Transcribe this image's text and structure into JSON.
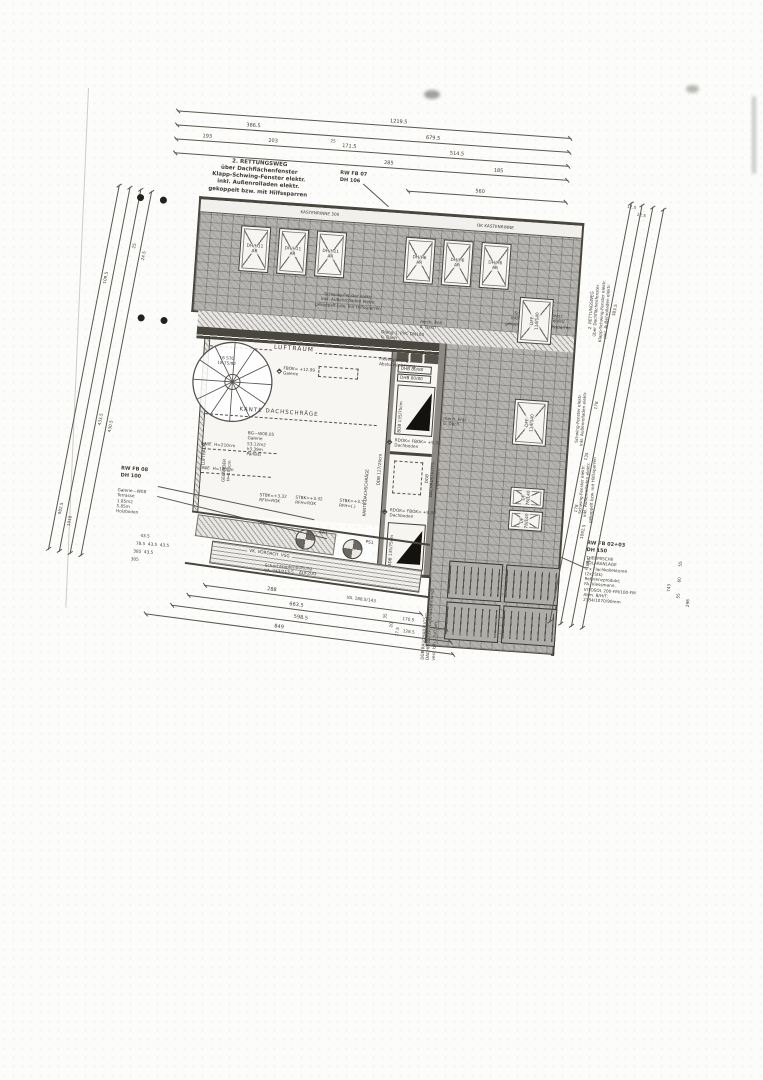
{
  "colors": {
    "paper": "#fcfcfa",
    "ink": "#3e3b37",
    "hatch": "#b4b3b0",
    "wall": "#49463f"
  },
  "notes": {
    "rescue_top": "2. RETTUNGSWEG\nüber Dachflächenfenster\nKlapp-Schwing-Fenster elektr.\ninkl. Außenrolladen elektr.\ngekoppelt bzw. mit Hilfssparren",
    "rw_fb07": "RW FB 07\nDH 106",
    "schwing_left": "Schwing-Fenster elektr.\ninkl. Außenrolladen elektr.\ngekoppelt bzw. mit Hilfssparren",
    "schwing_right": "Schwing-Fenster elektr.\ninkl. Außenrolladen elektr.\ngekoppelt bzw. mit Hilfssparren",
    "margin_rescue": "2. RETTUNGSWEG\nüber Dachflächenfenster\nKlapp-Schwing-Fenster elektr.\ninkl. Außenrolladen elektr.",
    "margin_schwing_a": "Schwing-Fenster elektr.\ninkl. Außenrolladen elektr.",
    "margin_schwing_b": "Schwing-Fenster elektr.\ninkl. Außenrolladen elektr.\ngekoppelt bzw. mit Hilfssparren",
    "rw_fb08": "RW FB 08\nDH 100",
    "terrasse": "Galerie—W08\nTerrasse\n1.85m2\n5.85m\nHolzboden",
    "rw_fb0203": "RW FB 02+03\nDH 150",
    "solar": "THERMISCHE\nSOLARANLAGE\n4 x Flachkollektoren\n(2x2Stk)\nReferenzprodukt:\nFA. Viessmann,\nVITOSOL 200-FM/100-FM\nAbm. B/H/T:\n2384/1070/90mm",
    "rauchabzug": "DÜB RAUCHABZUGS—\nDACHFENSTER (Gefälledämmung)\nverz. b/h 1,5/0,5m"
  },
  "gutter": {
    "left": "KASTENRINNE 300",
    "right": "OK KASTENRINNE"
  },
  "skylights": {
    "top_left": [
      "DH/H11\nAR",
      "DH/H11\nAR",
      "DH/H11\nAR"
    ],
    "top_right": [
      "DH/H6\nAR",
      "DH/H6\nAR",
      "DH/H6\nAR"
    ],
    "side": [
      "DFF\n114/140",
      "DFF\n114/140",
      "DF\n78/140",
      "DF\n78/140"
    ]
  },
  "gallery": {
    "luftraum": "LUFTRAUM",
    "luftraum_v": "LUFTRAUM",
    "stair": "16 STG\n18.75/92",
    "fbok": "FBOK= +12.99\nGalerie",
    "kante_h": "KANTE DACHSCHRÄGE",
    "kante_v": "KANTE DACHSCHRÄGE",
    "room": "BG—W08.05\nGalerie\n53.12m2\nh3.39m\nParkett",
    "linie210": "LINIE  H=210cm",
    "linie180": "LINIE  H=180cm",
    "gelaender": "GELÄNDER\nH=100cm",
    "ddb": "DDB 127/26cm",
    "stbk_a": "STBK=+3.32\nRFH=ROK",
    "stbk_b": "STBK=+3.32\nRFH=ROK",
    "stbk_c": "STBK=+3.32\nRFH=(.)",
    "mech_a": "mech. Entl.\nü. Dach",
    "mech_b": "Dlang 1, PVC DN100\nü. Dach",
    "fixverglasung": "Fixverglasung\nAbsturzsicherung"
  },
  "corridor": {
    "dhb_a": "DHB 80/80",
    "dhb_b": "DHB 80/80",
    "bdb_a": "BDB 135/75cm",
    "bdb_b": "BDB 135/75cm",
    "rdok_a": "RDOK= FBOK= +9.30\nDachboden",
    "rdok_b": "RDOK= FBOK= +9.30\nDachboden",
    "dachaustritt": "DGB\nDACHAUSTRITTS-\nFENSTER",
    "mech_c": "mech. Entl.\nü. Dach"
  },
  "bottom": {
    "vordach": "VK. VORDACH  VSG",
    "schacht": "Schachtkopfentlüftung\nVA. 243/213.5    AUFZUG",
    "circle_a": "AW1",
    "circle_b": "PS1"
  },
  "dims": {
    "top": {
      "total": "1219.5",
      "l2a": "386.5",
      "l2b": "679.5",
      "l3a": "193",
      "l3b": "203",
      "l3c": "25",
      "l3d": "171.5",
      "l3e": "514.5",
      "l4a": "285",
      "l4b": "185",
      "rw_seg": "560"
    },
    "left": {
      "a": "25",
      "b": "24.5",
      "c": "109.5",
      "d": "433.5",
      "e": "430.5",
      "f": "982.5",
      "g": "1018"
    },
    "right": {
      "a": "12.5",
      "b": "12.5",
      "c": "383.5",
      "d": "178",
      "e": "135",
      "f": "178",
      "g": "1092.5",
      "h": "1848"
    },
    "right_solar": {
      "a": "743",
      "b": "55",
      "c": "60",
      "d": "55",
      "e": "298"
    },
    "bottom": {
      "a": "288",
      "b": "663.5",
      "c": "598.5",
      "d": "849",
      "e": "170.5",
      "f": "128.5",
      "g": "35",
      "h": "20",
      "i": "17.5",
      "va": "VA. 188.5/143"
    },
    "bottom_left": {
      "r1": "43.5",
      "r2": "78.5  43.5  43.5",
      "r3": "385  43.5",
      "r4": "305"
    }
  }
}
